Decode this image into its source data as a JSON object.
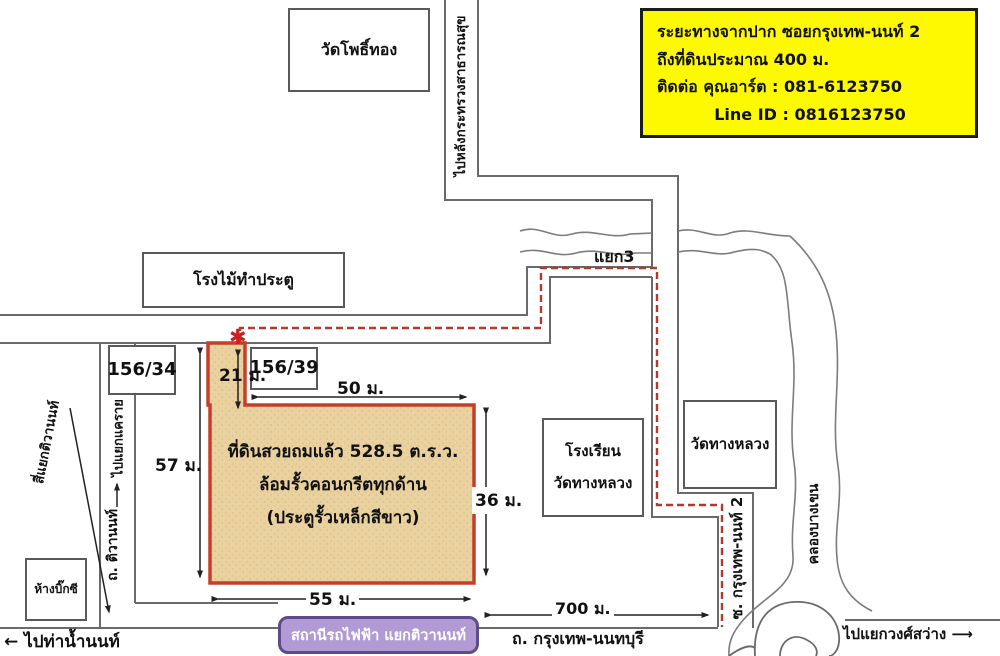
{
  "info_box": {
    "line1": "ระยะทางจากปาก ซอยกรุงเทพ-นนท์ 2",
    "line2": "ถึงที่ดินประมาณ 400 ม.",
    "line3": "ติดต่อ คุณอาร์ต  :  081-6123750",
    "line4": "Line ID :  0816123750",
    "bg_color": "#fdf900"
  },
  "plot": {
    "line1": "ที่ดินสวยถมแล้ว 528.5 ต.ร.ว.",
    "line2": "ล้อมรั้วคอนกรีตทุกด้าน",
    "line3": "(ประตูรั้วเหล็กสีขาว)",
    "fill_color": "#e9d2a0",
    "border_color": "#c63e2a",
    "entrance_marker": "✱",
    "dimensions": {
      "strip": "21 ม.",
      "top": "50 ม.",
      "left": "57 ม.",
      "right": "36 ม.",
      "bottom": "55 ม."
    }
  },
  "places": {
    "wat_pho_thong": "วัดโพธิ์ทอง",
    "wood_factory": "โรงไม้ทำประตู",
    "house_156_34": "156/34",
    "house_156_39": "156/39",
    "school_line1": "โรงเรียน",
    "school_line2": "วัดทางหลวง",
    "wat_thang_luang": "วัดทางหลวง",
    "big_c": "ห้างบิ๊กซี",
    "mrt_station": "สถานีรถไฟฟ้า แยกติวานนท์"
  },
  "roads": {
    "to_ministry": "ไปหลังกระทรวงสาธารณสุข",
    "soi_krungthep_non_2": "ซ. กรุงเทพ-นนท์ 2",
    "khlong_bang_khen": "คลองบางเขน",
    "thanon_tiwanon": "ถ. ติวานนท์",
    "to_khae_rai": "ไปแยกแคราย",
    "si_yaek_tiwanon": "สี่แยกติวานนท์",
    "junction3": "แยก3",
    "krungthep_nonthaburi": "ถ. กรุงเทพ-นนทบุรี",
    "to_tha_nam_non": "← ไปท่าน้ำนนท์",
    "to_wong_sawang": "ไปแยกวงศ์สว่าง ⟶",
    "distance_700": "700 ม."
  }
}
